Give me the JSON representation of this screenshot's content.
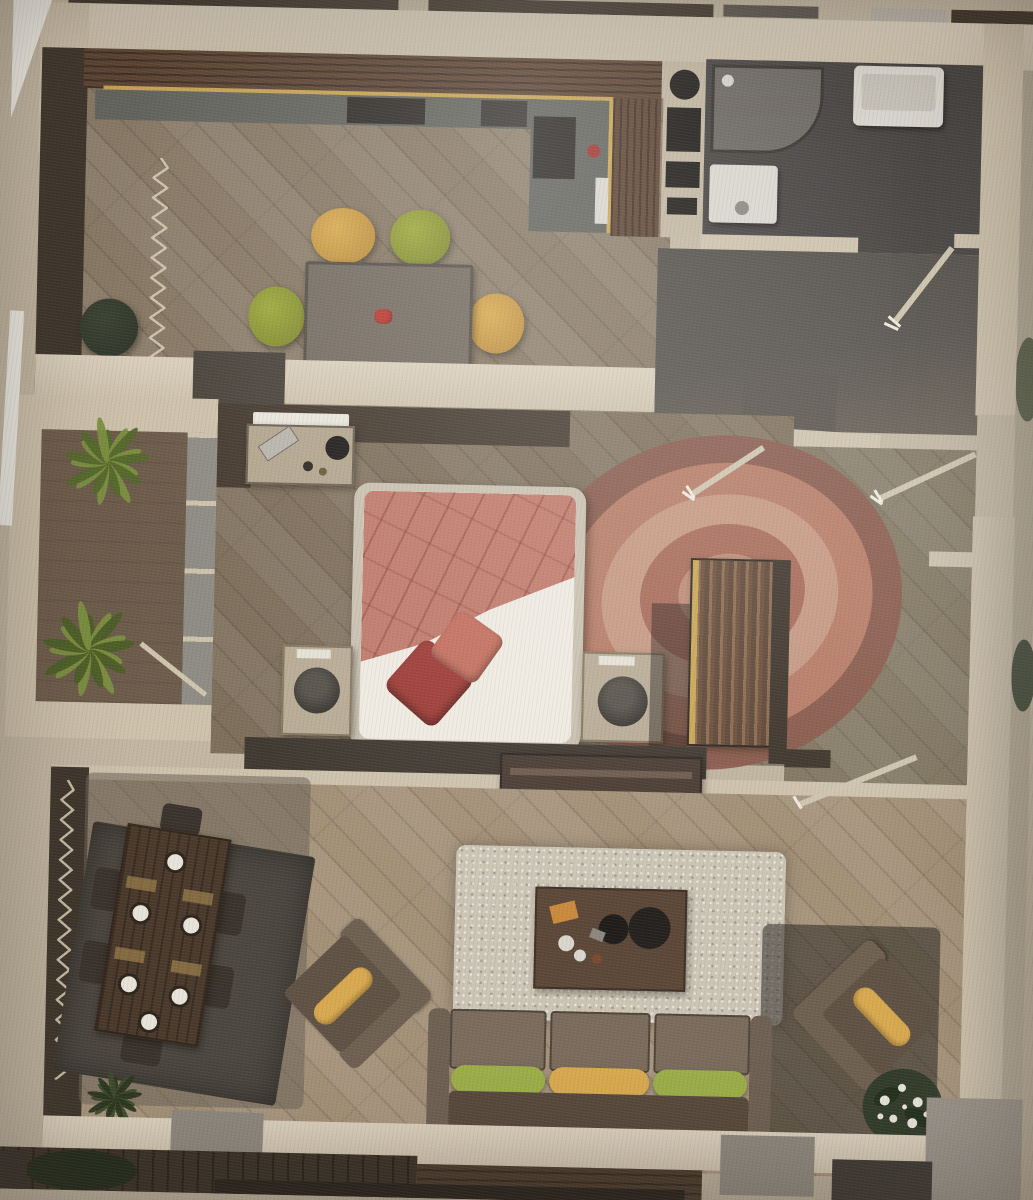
{
  "scene": {
    "type": "floor-plan-photo",
    "view": "top-down 3D rendered apartment plan, photographed on paper",
    "rooms": [
      {
        "name": "kitchen-dining",
        "furniture": [
          "L-shaped wooden counter with gold trim",
          "cooktop",
          "sink",
          "appliance column",
          "rectangular dining table",
          "four round chairs",
          "dark floor pouf",
          "radiator"
        ]
      },
      {
        "name": "bathroom",
        "furniture": [
          "corner shower",
          "washbasin",
          "washing machine"
        ]
      },
      {
        "name": "hallway",
        "furniture": [
          "entrance door",
          "bedroom door",
          "storage door",
          "wall stub"
        ]
      },
      {
        "name": "bedroom",
        "furniture": [
          "double bed with coral blanket",
          "two red pillows",
          "round swirl rug",
          "two nightstands with lamps",
          "writing desk",
          "striped wardrobe",
          "tv console",
          "radiator"
        ]
      },
      {
        "name": "living-room",
        "furniture": [
          "six-seat dining table with plates",
          "dark rug",
          "three-seat sofa",
          "two diagonal lounge chairs",
          "coffee table",
          "shaggy light rug",
          "flowering plant",
          "radiator"
        ]
      },
      {
        "name": "balcony",
        "furniture": [
          "two potted plants",
          "glazed wall",
          "balcony door"
        ]
      },
      {
        "name": "lower-terrace",
        "furniture": [
          "support columns",
          "plants",
          "plank decking"
        ]
      }
    ],
    "accents": {
      "dining_chairs": [
        "yellow",
        "green",
        "green",
        "yellow"
      ],
      "sofa_bolsters": [
        "green",
        "yellow",
        "green"
      ],
      "armchair_bolsters": [
        "yellow",
        "yellow"
      ],
      "bed_textiles": [
        "coral blanket",
        "dark red pillow",
        "coral pillow"
      ]
    }
  },
  "palette": {
    "photo-bg": "#f1efe9",
    "paper": "#c3b7a2",
    "paper-right": "#b0a693",
    "wall-light": "#cec2ac",
    "wall-light-hi": "#dbd0bd",
    "wall-dark": "#3e352b",
    "wall-dark2": "#463b30",
    "wall-gray": "#57524b",
    "column-gray": "#8d877d",
    "corner-gray": "#9a938a",
    "kitchen-floor": "#887965",
    "bedroom-floor": "#7e6f5b",
    "living-floor": "#a39077",
    "balcony-floor": "#6d5c4b",
    "bath-floor": "#454240",
    "hall-floor-dark": "#55514b",
    "hall-floor": "#80755f",
    "terrace-floor": "#3a3127",
    "terrace-mid": "#4a3b2d",
    "counter-wood": "#5d4433",
    "gold": "#c9a553",
    "counter-gray": "#63645e",
    "appliance-beige": "#c2b6a0",
    "black": "#1f1c19",
    "table-gray": "#766d62",
    "chair-yellow": "#d9ab51",
    "chair-green": "#9da93c",
    "pouf-green": "#2f3428",
    "shower-gray": "#6b6762",
    "fixture-white": "#d9d6ce",
    "door-line": "#cfc5ae",
    "handle-white": "#efeadf",
    "desk-beige": "#b3a68f",
    "bed-frame": "#c9c1b0",
    "mattress": "#efebe2",
    "blanket": "#c07a6b",
    "pillow-dark": "#9e3c37",
    "pillow-coral": "#c4705f",
    "rug-outer": "#8a5a4c",
    "rug-2": "#b97c66",
    "rug-3": "#c89a83",
    "rug-4": "#a96a59",
    "rug-center": "#c08d77",
    "nightstand": "#b9ac96",
    "lamp-dark": "#3b3834",
    "wardrobe-dark": "#5e4636",
    "wardrobe-light": "#8a6a4e",
    "tv-console": "#4a3c33",
    "dining-rug": "#4b463f",
    "dining-table": "#4a392b",
    "plate": "#e8e4da",
    "shag-rug": "#ccc5b5",
    "coffee-table": "#5c4737",
    "orange-item": "#c98a3c",
    "sofa-body": "#7a6b5c",
    "sofa-dark": "#57493c",
    "sofa-arm": "#6e6052",
    "bolster-green": "#9cae48",
    "bolster-yellow": "#d8a94f",
    "armchair": "#6e6051",
    "plant-green": "#7c903f",
    "plant-dark": "#55682c",
    "bloom-green": "#2f3b28",
    "bloom-white": "#e8e6dc",
    "radiator-red": "#a2493f",
    "radiator-light": "#d6cbb2"
  }
}
